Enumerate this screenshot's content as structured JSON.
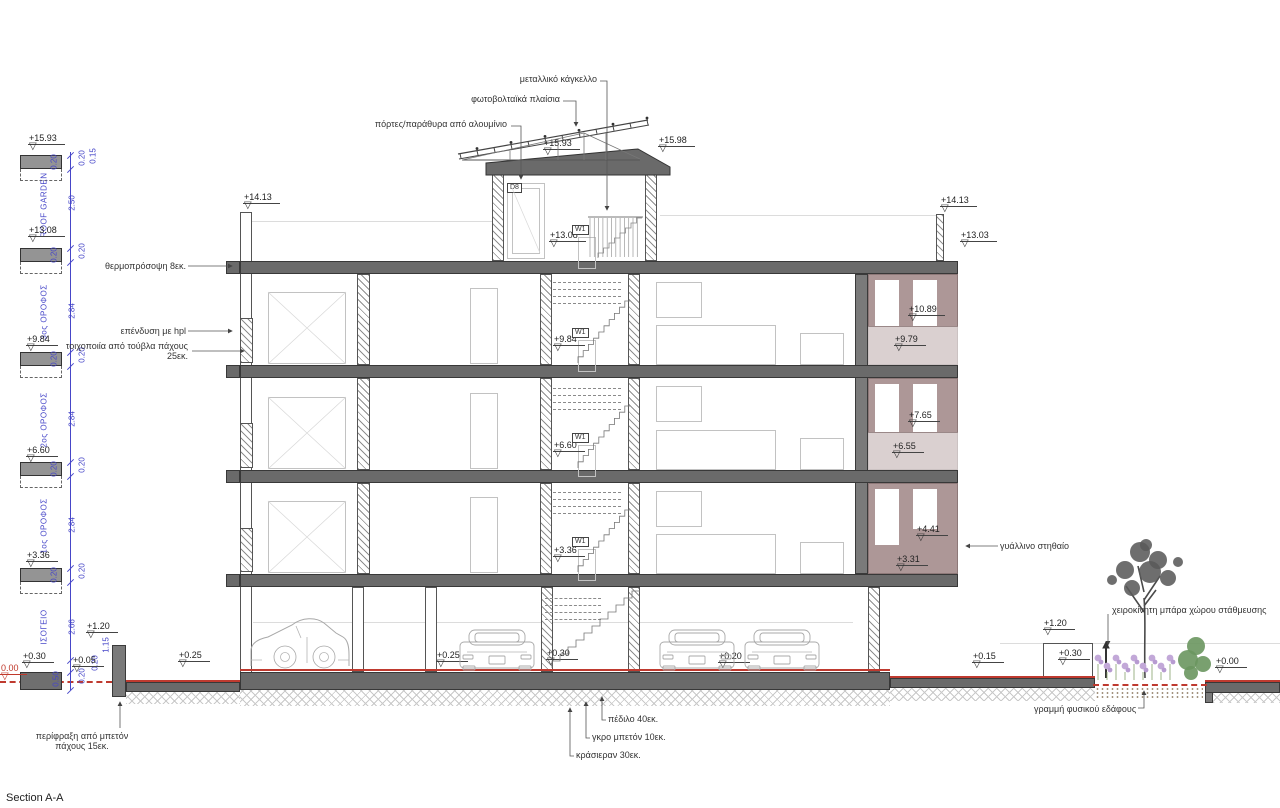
{
  "title": "Section A-A",
  "icons": {
    "level_marker": "▽"
  },
  "colors": {
    "balcony_mauve": "#ad9797",
    "slab_gray": "#6a6a6a",
    "dimension_blue": "#4646c8",
    "ground_line_red": "#bf3a2f"
  },
  "tags": {
    "door": "D8",
    "window": "W1"
  },
  "annotations": {
    "top": [
      {
        "id": "metal-railing",
        "text": "μεταλλικό κάγκελλο"
      },
      {
        "id": "pv-panels",
        "text": "φωτοβολταϊκά πλαίσια"
      },
      {
        "id": "alu-doors",
        "text": "πόρτες/παράθυρα από αλουμίνιο"
      }
    ],
    "left": [
      {
        "id": "thermal-facade",
        "text": "θερμοπρόσοψη 8εκ."
      },
      {
        "id": "hpl-cladding",
        "text": "επένδυση με hpl"
      },
      {
        "id": "brick-wall",
        "text": "τοιχοποιία από τούβλα πάχους 25εκ."
      }
    ],
    "right": [
      {
        "id": "glass-parapet",
        "text": "γυάλλινο στηθαίο"
      }
    ],
    "bottom": [
      {
        "id": "footing",
        "text": "πέδιλο 40εκ."
      },
      {
        "id": "lean-concrete",
        "text": "γκρο μπετόν 10εκ."
      },
      {
        "id": "crusher-run",
        "text": "κράσιεραν 30εκ."
      },
      {
        "id": "fence",
        "text": "περίφραξη από μπετόν πάχους 15εκ."
      },
      {
        "id": "natural-ground",
        "text": "γραμμή φυσικού εδάφους"
      },
      {
        "id": "parking-barrier",
        "text": "χειροκίνητη μπάρα χώρου στάθμευσης"
      }
    ]
  },
  "floor_labels": [
    {
      "id": "roof-garden",
      "text": "ROOF GARDEN"
    },
    {
      "id": "floor-3",
      "text": "3ος ΟΡΟΦΟΣ"
    },
    {
      "id": "floor-2",
      "text": "2ος ΟΡΟΦΟΣ"
    },
    {
      "id": "floor-1",
      "text": "1ος ΟΡΟΦΟΣ"
    },
    {
      "id": "ground-floor",
      "text": "ΙΣΟΓΕΙΟ"
    }
  ],
  "levels": [
    {
      "id": "lc1593",
      "value": "+15.93"
    },
    {
      "id": "lc1308",
      "value": "+13.08"
    },
    {
      "id": "lc984",
      "value": "+9.84"
    },
    {
      "id": "lc660",
      "value": "+6.60"
    },
    {
      "id": "lc336",
      "value": "+3.36"
    },
    {
      "id": "lc030",
      "value": "+0.30"
    },
    {
      "id": "lc005",
      "value": "+0.05"
    },
    {
      "id": "lc000",
      "value": "0.00",
      "color": "red"
    },
    {
      "id": "top1593",
      "value": "+15.93"
    },
    {
      "id": "top1598",
      "value": "+15.98"
    },
    {
      "id": "pl1413",
      "value": "+14.13"
    },
    {
      "id": "pr1413",
      "value": "+14.13"
    },
    {
      "id": "pr1303",
      "value": "+13.03"
    },
    {
      "id": "st1308",
      "value": "+13.08"
    },
    {
      "id": "st984",
      "value": "+9.84"
    },
    {
      "id": "st660",
      "value": "+6.60"
    },
    {
      "id": "st336",
      "value": "+3.36"
    },
    {
      "id": "b1089",
      "value": "+10.89"
    },
    {
      "id": "b979",
      "value": "+9.79"
    },
    {
      "id": "b765",
      "value": "+7.65"
    },
    {
      "id": "b655",
      "value": "+6.55"
    },
    {
      "id": "b441",
      "value": "+4.41"
    },
    {
      "id": "b331",
      "value": "+3.31"
    },
    {
      "id": "g025a",
      "value": "+0.25"
    },
    {
      "id": "g025b",
      "value": "+0.25"
    },
    {
      "id": "g030",
      "value": "+0.30"
    },
    {
      "id": "g020",
      "value": "+0.20"
    },
    {
      "id": "g015",
      "value": "+0.15"
    },
    {
      "id": "g120l",
      "value": "+1.20"
    },
    {
      "id": "g120r",
      "value": "+1.20"
    },
    {
      "id": "g030r",
      "value": "+0.30"
    },
    {
      "id": "g000r",
      "value": "+0.00"
    }
  ],
  "dimensions": [
    {
      "id": "v250",
      "value": "2.50"
    },
    {
      "id": "v284a",
      "value": "2.84"
    },
    {
      "id": "v284b",
      "value": "2.84"
    },
    {
      "id": "v284c",
      "value": "2.84"
    },
    {
      "id": "v266",
      "value": "2.66"
    },
    {
      "id": "v050",
      "value": "0.50"
    },
    {
      "id": "v115",
      "value": "1.15"
    },
    {
      "id": "v015",
      "value": "0.15"
    },
    {
      "id": "l1",
      "value": "0.20"
    },
    {
      "id": "l2",
      "value": "0.20"
    },
    {
      "id": "l3",
      "value": "0.20"
    },
    {
      "id": "l4",
      "value": "0.20"
    },
    {
      "id": "l5",
      "value": "0.20"
    },
    {
      "id": "r1",
      "value": "0.20"
    },
    {
      "id": "r2",
      "value": "0.20"
    },
    {
      "id": "r3",
      "value": "0.20"
    },
    {
      "id": "r4",
      "value": "0.20"
    },
    {
      "id": "r5",
      "value": "0.20"
    },
    {
      "id": "b1",
      "value": "0.20"
    },
    {
      "id": "b2",
      "value": "0.20"
    }
  ]
}
